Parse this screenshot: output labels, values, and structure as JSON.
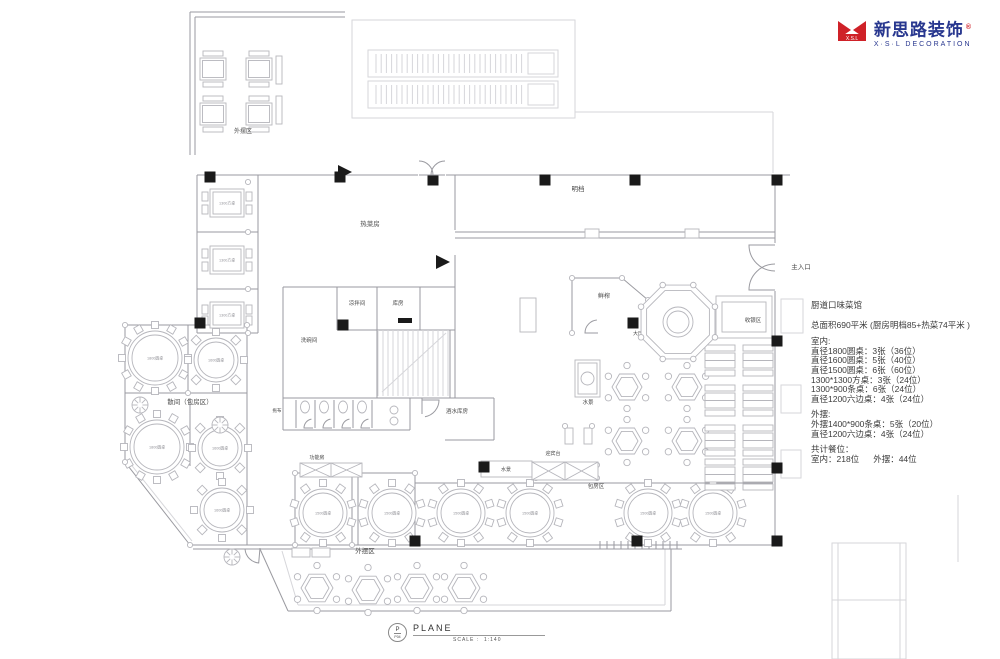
{
  "logo": {
    "icon_text": "X.S.L",
    "name_cn": "新思路装饰",
    "reg": "®",
    "name_en": "X·S·L DECORATION",
    "red": "#cf2128",
    "blue": "#28378f"
  },
  "annotation": {
    "title": "厨道口味菜馆",
    "area_line": "总面积690平米 (厨房明档85+热菜74平米 )",
    "indoor_header": "室内:",
    "indoor_lines": [
      "直径1800圆桌：3张（36位）",
      "直径1600圆桌：5张（40位）",
      "直径1500圆桌：6张（60位）",
      "1300*1300方桌：3张（24位）",
      "1300*900条桌：6张（24位）",
      "直径1200六边桌：4张（24位）"
    ],
    "outdoor_header": "外摆:",
    "outdoor_lines": [
      "外摆1400*900条桌：5张（20位）",
      "直径1200六边桌：4张（24位）"
    ],
    "total_header": "共计餐位：",
    "total_indoor": "室内：218位",
    "total_outdoor": "外摆：44位"
  },
  "titleblock": {
    "p": "P",
    "p_sub": "P04",
    "name": "PLANE",
    "scale_label": "SCALE :",
    "scale_value": "1:140"
  },
  "plan": {
    "labels": [
      {
        "t": "外摆区",
        "x": 243,
        "y": 133,
        "s": 6
      },
      {
        "t": "热菜房",
        "x": 370,
        "y": 226,
        "s": 6.5
      },
      {
        "t": "明档",
        "x": 578,
        "y": 191,
        "s": 6.5
      },
      {
        "t": "凉拌间",
        "x": 357,
        "y": 305,
        "s": 5.5
      },
      {
        "t": "库房",
        "x": 398,
        "y": 305,
        "s": 5.5
      },
      {
        "t": "洗碗间",
        "x": 309,
        "y": 342,
        "s": 5.5
      },
      {
        "t": "酒水库房",
        "x": 457,
        "y": 413,
        "s": 5.5
      },
      {
        "t": "拖布",
        "x": 277,
        "y": 412,
        "s": 4.5
      },
      {
        "t": "鲜榨",
        "x": 604,
        "y": 298,
        "s": 6
      },
      {
        "t": "大厅通道",
        "x": 643,
        "y": 335,
        "s": 5
      },
      {
        "t": "收银区",
        "x": 753,
        "y": 322,
        "s": 5.5
      },
      {
        "t": "主入口",
        "x": 801,
        "y": 269,
        "s": 6.5
      },
      {
        "t": "散间（包房区）",
        "x": 190,
        "y": 404,
        "s": 6.5
      },
      {
        "t": "水景",
        "x": 588,
        "y": 404,
        "s": 5.5
      },
      {
        "t": "水景",
        "x": 506,
        "y": 471,
        "s": 5
      },
      {
        "t": "功能房",
        "x": 317,
        "y": 459,
        "s": 5
      },
      {
        "t": "迎宾台",
        "x": 553,
        "y": 455,
        "s": 5
      },
      {
        "t": "包房区",
        "x": 596,
        "y": 488,
        "s": 5.5
      },
      {
        "t": "外摆区",
        "x": 365,
        "y": 553,
        "s": 6.5
      }
    ],
    "walls": [
      [
        190,
        12,
        345,
        12
      ],
      [
        190,
        12,
        190,
        155
      ],
      [
        195,
        17,
        345,
        17
      ],
      [
        195,
        17,
        195,
        155
      ],
      [
        197,
        175,
        418,
        175
      ],
      [
        446,
        175,
        790,
        175
      ],
      [
        775,
        175,
        775,
        243
      ],
      [
        775,
        291,
        775,
        545
      ],
      [
        190,
        545,
        775,
        545
      ],
      [
        193,
        549,
        682,
        549
      ],
      [
        197,
        175,
        197,
        333
      ],
      [
        258,
        175,
        258,
        333
      ],
      [
        197,
        232,
        258,
        232
      ],
      [
        197,
        289,
        258,
        289
      ],
      [
        197,
        333,
        258,
        333
      ],
      [
        125,
        325,
        247,
        325
      ],
      [
        125,
        325,
        125,
        462
      ],
      [
        125,
        462,
        190,
        545
      ],
      [
        247,
        325,
        247,
        545
      ],
      [
        125,
        393,
        247,
        393
      ],
      [
        188,
        325,
        188,
        393
      ],
      [
        190,
        398,
        190,
        466
      ],
      [
        258,
        175,
        258,
        287
      ],
      [
        283,
        287,
        283,
        430
      ],
      [
        283,
        287,
        455,
        287
      ],
      [
        337,
        287,
        337,
        330
      ],
      [
        377,
        287,
        377,
        330
      ],
      [
        420,
        287,
        420,
        330
      ],
      [
        337,
        330,
        455,
        330
      ],
      [
        455,
        175,
        455,
        230
      ],
      [
        455,
        255,
        455,
        398
      ],
      [
        377,
        330,
        377,
        398
      ],
      [
        450,
        330,
        450,
        398
      ],
      [
        377,
        398,
        450,
        398
      ],
      [
        283,
        398,
        410,
        398
      ],
      [
        283,
        430,
        410,
        430
      ],
      [
        410,
        398,
        410,
        430
      ],
      [
        422,
        398,
        494,
        398
      ],
      [
        494,
        398,
        494,
        440
      ],
      [
        445,
        440,
        494,
        440
      ],
      [
        422,
        398,
        422,
        414
      ],
      [
        455,
        232,
        775,
        232
      ],
      [
        455,
        238,
        775,
        238
      ],
      [
        572,
        278,
        622,
        278
      ],
      [
        572,
        278,
        572,
        333
      ],
      [
        622,
        278,
        648,
        300
      ],
      [
        648,
        300,
        648,
        333
      ],
      [
        295,
        473,
        415,
        473
      ],
      [
        295,
        473,
        295,
        545
      ],
      [
        352,
        473,
        352,
        545
      ],
      [
        358,
        473,
        358,
        545
      ],
      [
        415,
        473,
        415,
        545
      ],
      [
        415,
        483,
        773,
        483
      ],
      [
        260,
        549,
        288,
        611
      ],
      [
        288,
        611,
        671,
        611
      ],
      [
        671,
        611,
        671,
        549
      ]
    ],
    "faintLines": [
      [
        575,
        112,
        773,
        112
      ],
      [
        773,
        112,
        773,
        173
      ],
      [
        838,
        543,
        838,
        659
      ],
      [
        900,
        543,
        900,
        659
      ],
      [
        832,
        600,
        906,
        600
      ],
      [
        958,
        495,
        958,
        562
      ],
      [
        129,
        462,
        192,
        541
      ],
      [
        282,
        551,
        298,
        605
      ],
      [
        298,
        605,
        665,
        605
      ],
      [
        665,
        605,
        665,
        549
      ]
    ],
    "faintRects": [
      [
        352,
        20,
        223,
        98
      ],
      [
        781,
        299,
        22,
        34
      ],
      [
        781,
        385,
        20,
        28
      ],
      [
        781,
        450,
        20,
        28
      ],
      [
        832,
        543,
        74,
        116
      ]
    ],
    "strokeRects": [
      [
        716,
        296,
        56,
        42
      ],
      [
        722,
        302,
        44,
        30
      ],
      [
        520,
        298,
        16,
        34
      ],
      [
        565,
        428,
        8,
        16
      ],
      [
        584,
        428,
        8,
        16
      ],
      [
        481,
        461,
        51,
        16
      ]
    ],
    "xRects": [
      [
        532,
        462,
        66,
        18
      ],
      [
        300,
        463,
        62,
        14
      ]
    ],
    "columns": [
      [
        210,
        177
      ],
      [
        340,
        177
      ],
      [
        433,
        180
      ],
      [
        545,
        180
      ],
      [
        635,
        180
      ],
      [
        777,
        180
      ],
      [
        200,
        323
      ],
      [
        343,
        325
      ],
      [
        777,
        341
      ],
      [
        777,
        468
      ],
      [
        344,
        470
      ],
      [
        484,
        467
      ],
      [
        633,
        323
      ],
      [
        415,
        541
      ],
      [
        637,
        541
      ],
      [
        777,
        541
      ]
    ],
    "circlesSmall": [
      [
        125,
        325
      ],
      [
        247,
        325
      ],
      [
        125,
        462
      ],
      [
        190,
        545
      ],
      [
        295,
        473
      ],
      [
        352,
        473
      ],
      [
        358,
        473
      ],
      [
        415,
        473
      ],
      [
        188,
        393
      ],
      [
        536,
        465
      ],
      [
        536,
        478
      ],
      [
        597,
        465
      ],
      [
        597,
        478
      ],
      [
        565,
        426
      ],
      [
        592,
        426
      ],
      [
        572,
        278
      ],
      [
        622,
        278
      ],
      [
        648,
        300
      ],
      [
        572,
        333
      ],
      [
        648,
        333
      ],
      [
        295,
        545
      ],
      [
        352,
        545
      ],
      [
        248,
        182
      ],
      [
        248,
        232
      ],
      [
        248,
        289
      ],
      [
        248,
        333
      ]
    ],
    "roundTables": [
      [
        155,
        358,
        27,
        12,
        "1800圆桌"
      ],
      [
        216,
        360,
        22,
        8,
        "1600圆桌"
      ],
      [
        157,
        447,
        27,
        12,
        "1800圆桌"
      ],
      [
        220,
        448,
        22,
        8,
        "1600圆桌"
      ],
      [
        222,
        510,
        22,
        8,
        "1600圆桌"
      ],
      [
        323,
        513,
        24,
        10,
        "1500圆桌"
      ],
      [
        392,
        513,
        24,
        10,
        "1500圆桌"
      ],
      [
        461,
        513,
        24,
        10,
        "1500圆桌"
      ],
      [
        530,
        513,
        24,
        10,
        "1500圆桌"
      ],
      [
        648,
        513,
        24,
        10,
        "1500圆桌"
      ],
      [
        713,
        513,
        24,
        10,
        "1500圆桌"
      ]
    ],
    "hexTables": [
      [
        627,
        387,
        15
      ],
      [
        627,
        441,
        15
      ],
      [
        687,
        387,
        15
      ],
      [
        687,
        441,
        15
      ],
      [
        317,
        588,
        16
      ],
      [
        368,
        590,
        16
      ],
      [
        417,
        588,
        16
      ],
      [
        464,
        588,
        16
      ]
    ],
    "squareTablesLR": [
      [
        210,
        189,
        34,
        28,
        "1300方桌"
      ],
      [
        210,
        246,
        34,
        28,
        "1300方桌"
      ],
      [
        210,
        302,
        34,
        26,
        "1300方桌"
      ]
    ],
    "squareTablesTB": [
      [
        200,
        58,
        26,
        22
      ],
      [
        246,
        58,
        26,
        22
      ],
      [
        200,
        103,
        26,
        22
      ],
      [
        246,
        103,
        26,
        22
      ]
    ],
    "benches": [
      [
        276,
        56,
        6,
        28
      ],
      [
        276,
        96,
        6,
        28
      ],
      [
        292,
        548,
        18,
        9
      ],
      [
        312,
        548,
        18,
        9
      ]
    ],
    "booths": [
      [
        705,
        345
      ],
      [
        743,
        345
      ],
      [
        705,
        385
      ],
      [
        743,
        385
      ],
      [
        705,
        425
      ],
      [
        743,
        425
      ],
      [
        705,
        459
      ],
      [
        743,
        459
      ]
    ],
    "escalators": [
      [
        368,
        50
      ],
      [
        368,
        81
      ]
    ],
    "octagon": {
      "cx": 678,
      "cy": 322,
      "r": 40
    },
    "stairs": {
      "x": 378,
      "y": 330,
      "w": 70,
      "h": 66
    },
    "arcs": [
      [
        775,
        245,
        26,
        180,
        90
      ],
      [
        775,
        290,
        26,
        180,
        270
      ],
      [
        419,
        175,
        14,
        0,
        -90
      ],
      [
        445,
        175,
        14,
        180,
        270
      ],
      [
        422,
        400,
        17,
        0,
        80
      ],
      [
        260,
        548,
        15,
        95,
        175
      ],
      [
        598,
        333,
        13,
        180,
        265
      ]
    ],
    "markers": [
      [
        [
          338,
          165
        ],
        [
          352,
          172
        ],
        [
          338,
          179
        ]
      ],
      [
        [
          436,
          255
        ],
        [
          450,
          262
        ],
        [
          436,
          269
        ]
      ]
    ],
    "blackRects": [
      [
        398,
        318,
        14,
        5
      ]
    ],
    "plants": [
      [
        140,
        405
      ],
      [
        220,
        425
      ],
      [
        232,
        557
      ]
    ],
    "windows": [
      [
        585,
        229,
        14,
        9
      ],
      [
        685,
        229,
        14,
        9
      ]
    ],
    "ticks": {
      "x0": 600,
      "x1": 678,
      "step": 7,
      "y0": 541,
      "y1": 549
    },
    "fountain": {
      "x": 575,
      "y": 360,
      "w": 25,
      "h": 37
    }
  }
}
